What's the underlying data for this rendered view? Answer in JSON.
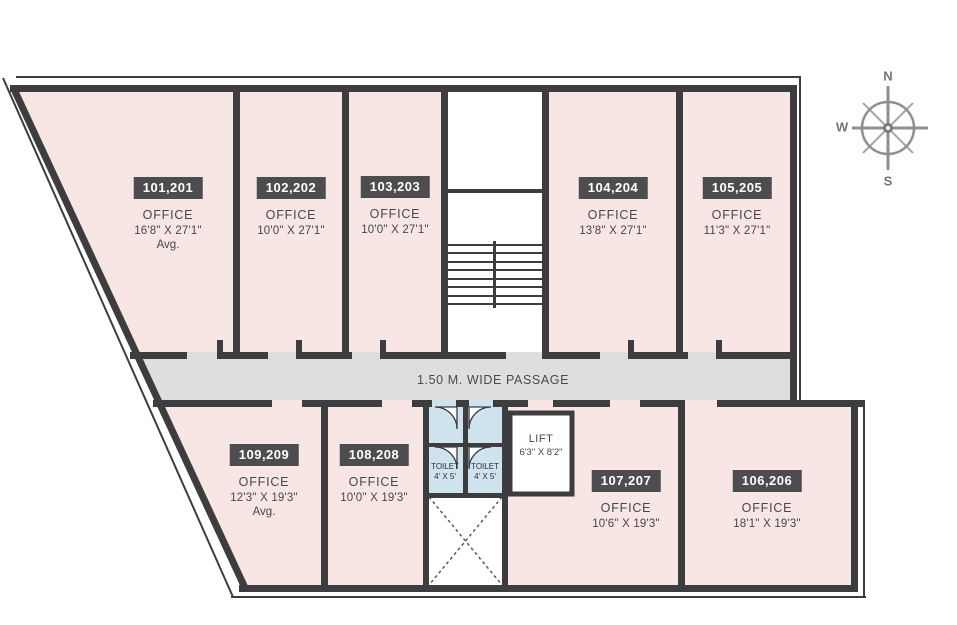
{
  "plan": {
    "passage": {
      "label": "1.50 M. WIDE PASSAGE"
    },
    "compass": {
      "north": "N",
      "west": "W",
      "south": "S"
    },
    "offices": [
      {
        "id": "101,201",
        "type": "OFFICE",
        "dims": "16'8\" X 27'1\"",
        "note": "Avg."
      },
      {
        "id": "102,202",
        "type": "OFFICE",
        "dims": "10'0\" X 27'1\""
      },
      {
        "id": "103,203",
        "type": "OFFICE",
        "dims": "10'0\" X 27'1\""
      },
      {
        "id": "104,204",
        "type": "OFFICE",
        "dims": "13'8\" X 27'1\""
      },
      {
        "id": "105,205",
        "type": "OFFICE",
        "dims": "11'3\" X 27'1\""
      },
      {
        "id": "106,206",
        "type": "OFFICE",
        "dims": "18'1\" X 19'3\""
      },
      {
        "id": "107,207",
        "type": "OFFICE",
        "dims": "10'6\" X 19'3\""
      },
      {
        "id": "108,208",
        "type": "OFFICE",
        "dims": "10'0\" X 19'3\""
      },
      {
        "id": "109,209",
        "type": "OFFICE",
        "dims": "12'3\" X 19'3\"",
        "note": "Avg."
      }
    ],
    "toilets": [
      {
        "label": "TOILET",
        "dims": "4' X 5'"
      },
      {
        "label": "TOILET",
        "dims": "4' X 5'"
      }
    ],
    "lift": {
      "label": "LIFT",
      "dims": "6'3\" X 8'2\""
    },
    "colors": {
      "wall": "#3d3d3f",
      "office_fill": "#f7e6e3",
      "passage_fill": "#dcdee0",
      "toilet_fill": "#cfe3ef",
      "badge_bg": "#4d4d4f",
      "text": "#474747"
    }
  }
}
